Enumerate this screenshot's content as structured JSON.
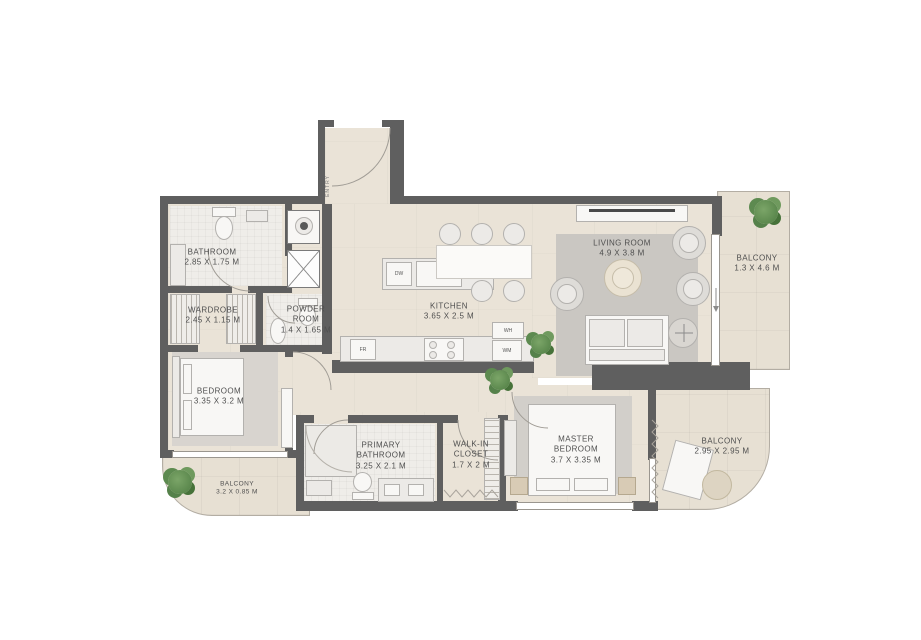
{
  "plan": {
    "rooms": [
      {
        "name": "BATHROOM",
        "dims": "2.85 X 1.75 M"
      },
      {
        "name": "WARDROBE",
        "dims": "2.45 X 1.15 M"
      },
      {
        "name": "POWDER ROOM",
        "dims": "1.4 X 1.65 M"
      },
      {
        "name": "BEDROOM",
        "dims": "3.35 X 3.2 M"
      },
      {
        "name": "KITCHEN",
        "dims": "3.65 X 2.5 M"
      },
      {
        "name": "LIVING ROOM",
        "dims": "4.9 X 3.8 M"
      },
      {
        "name": "BALCONY",
        "dims": "1.3 X 4.6 M"
      },
      {
        "name": "PRIMARY BATHROOM",
        "dims": "3.25 X 2.1 M"
      },
      {
        "name": "WALK-IN CLOSET",
        "dims": "1.7 X 2 M"
      },
      {
        "name": "MASTER BEDROOM",
        "dims": "3.7 X 3.35 M"
      },
      {
        "name": "BALCONY",
        "dims": "2.95 X 2.95 M"
      },
      {
        "name": "BALCONY",
        "dims": "3.2 X 0.85 M"
      }
    ],
    "appliances": {
      "dishwasher": "DW",
      "fridge": "FR",
      "washing_machine": "WM",
      "water_heater": "WH"
    },
    "entry_label": "ENTRY",
    "colors": {
      "wall": "#5f5f5f",
      "floor": "#eae3d7",
      "balcony_floor": "#e7e0d3",
      "bath_floor": "#efede9",
      "plant": "#5d8a50",
      "text": "#4f4f4f"
    }
  }
}
